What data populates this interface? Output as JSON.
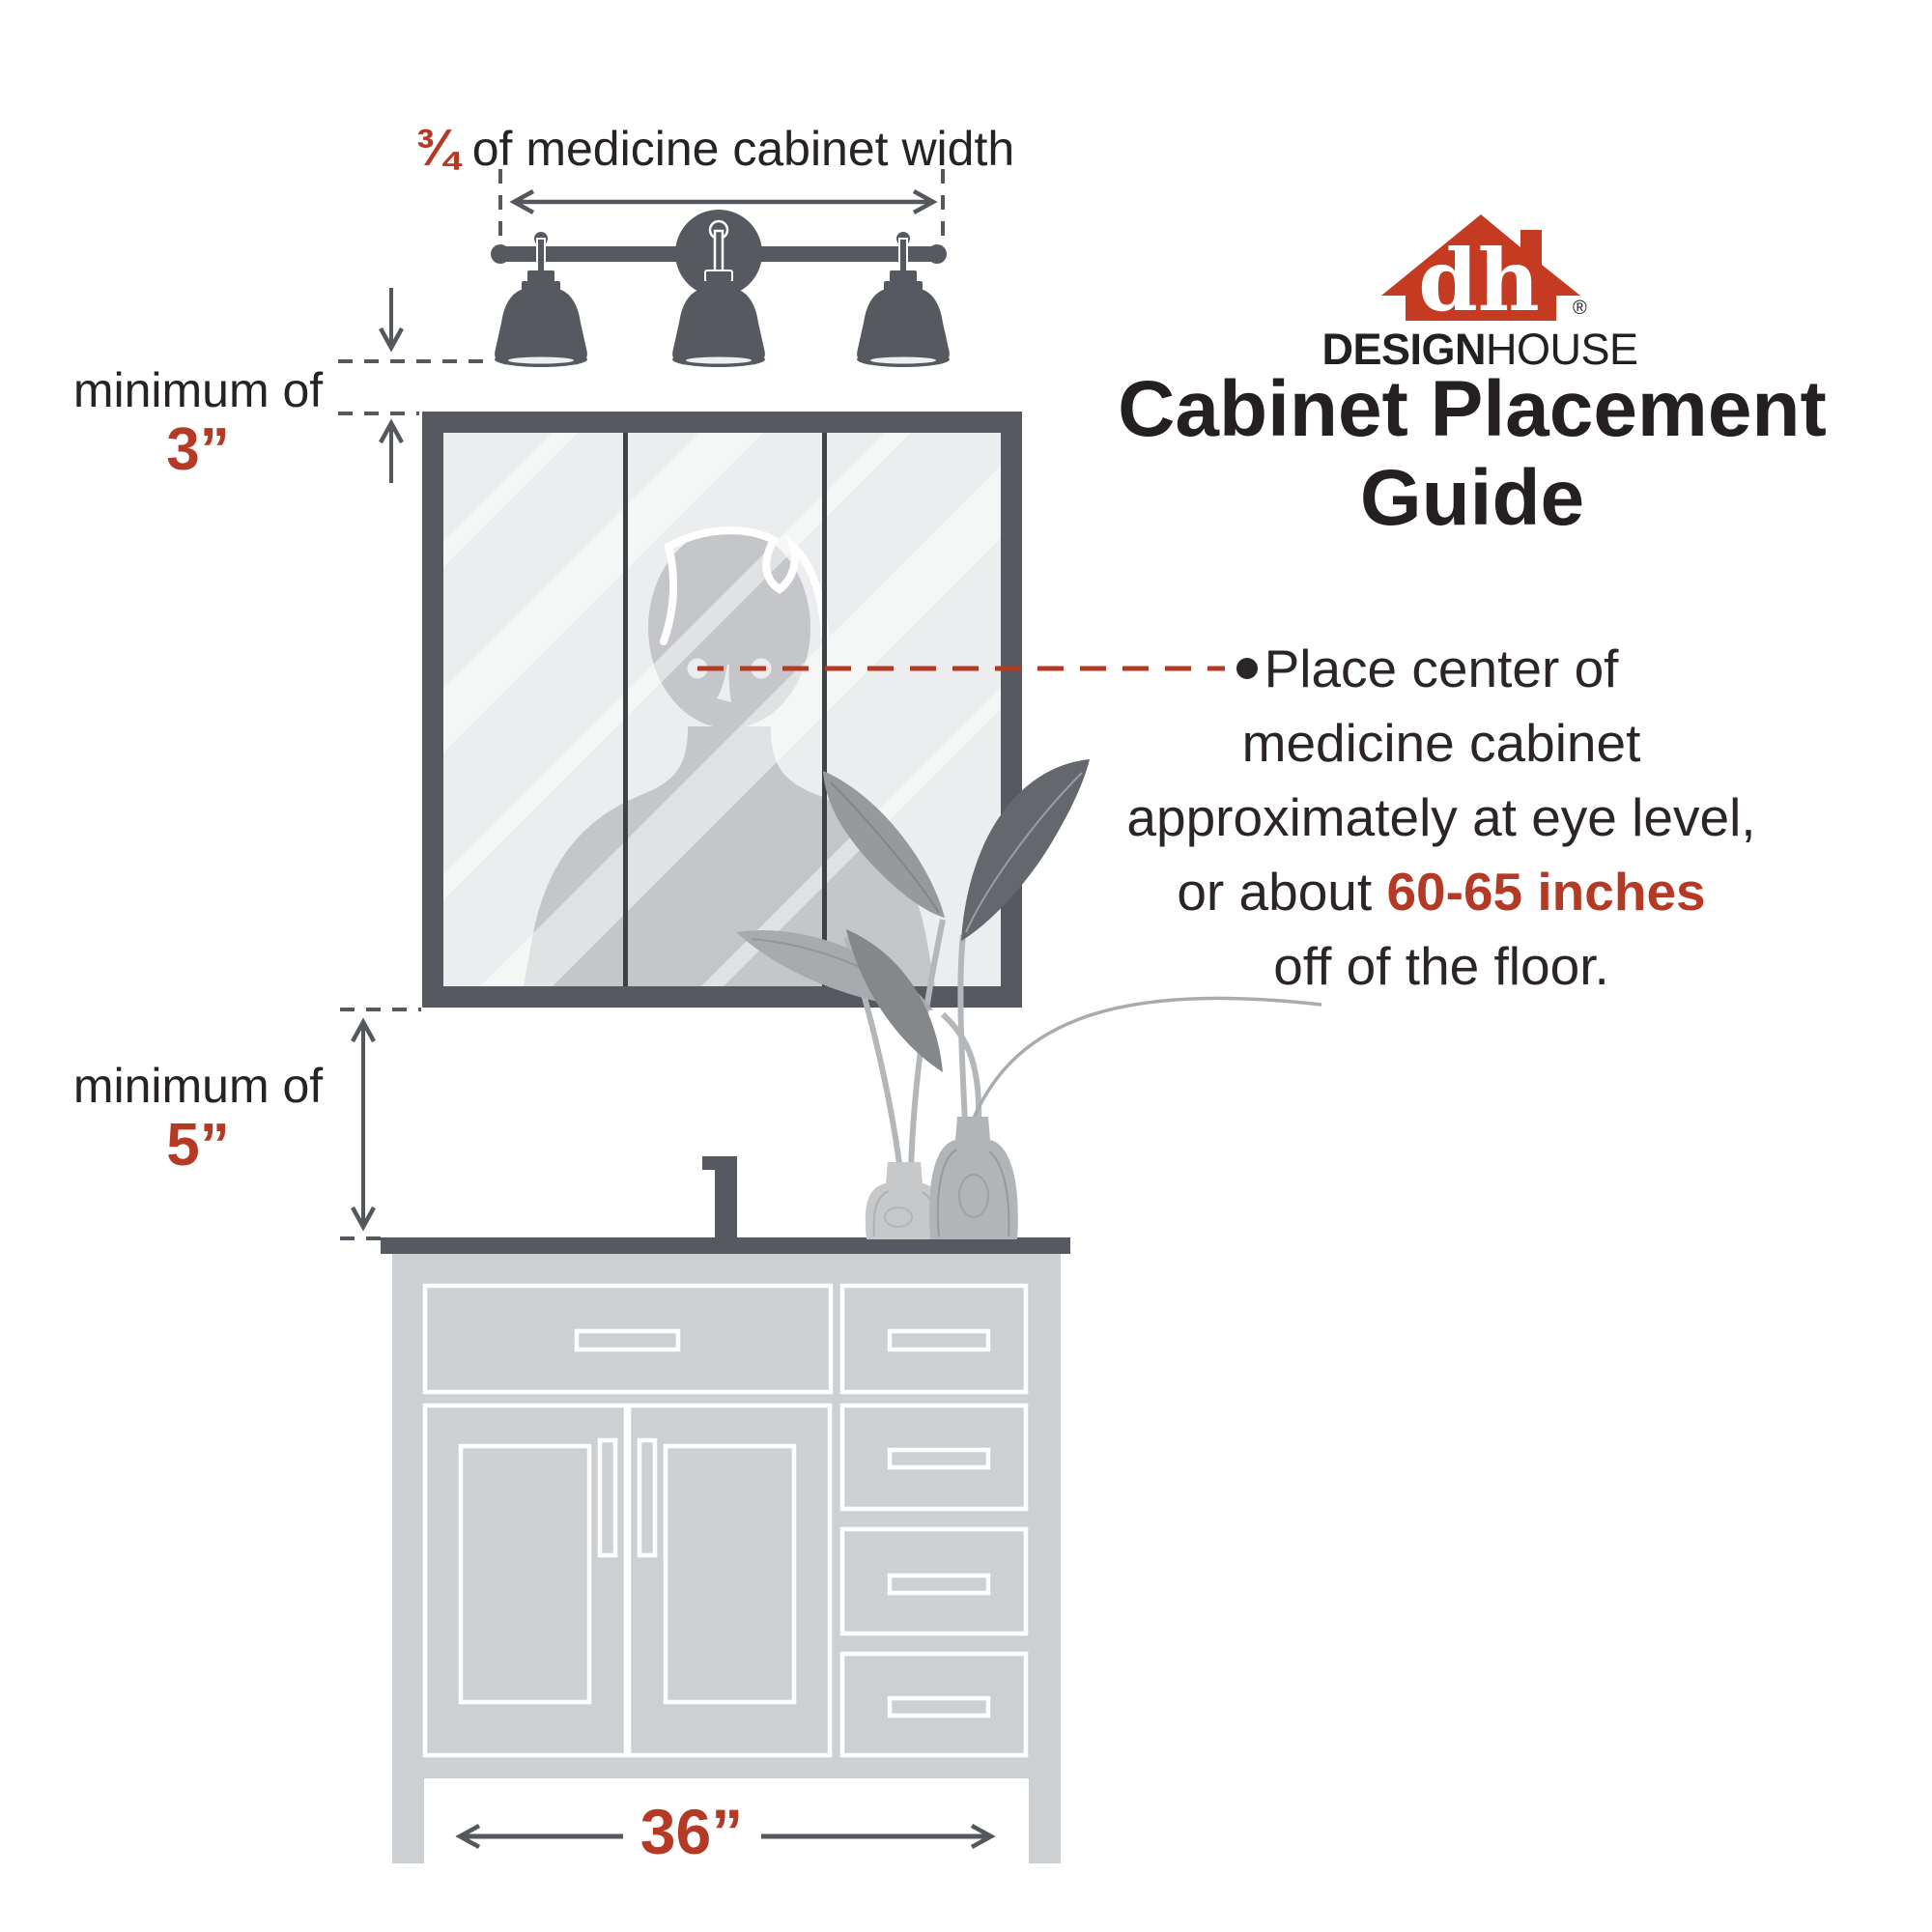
{
  "colors": {
    "accent_red": "#b43a26",
    "logo_red": "#c43b22",
    "dark_gray": "#565a60",
    "divider_gray": "#3e4146",
    "light_gray": "#cdd0d2",
    "mirror_gray": "#ebedee",
    "silhouette_gray": "#c4c6c9",
    "text_black": "#272324"
  },
  "top_dimension": {
    "fraction": "¾",
    "label": " of medicine cabinet width"
  },
  "gap_above": {
    "label": "minimum of",
    "value": "3”"
  },
  "gap_below": {
    "label": "minimum of",
    "value": "5”"
  },
  "vanity": {
    "width": "36”"
  },
  "brand": {
    "monogram": "dh",
    "registered": "®",
    "name_bold": "DESIGN",
    "name_light": "HOUSE"
  },
  "title": {
    "line1": "Cabinet Placement",
    "line2": "Guide"
  },
  "note": {
    "line1": "Place center of",
    "line2": "medicine cabinet",
    "line3": "approximately at eye level,",
    "line4_prefix": "or about ",
    "line4_highlight": "60-65 inches",
    "line5": "off of the floor."
  }
}
